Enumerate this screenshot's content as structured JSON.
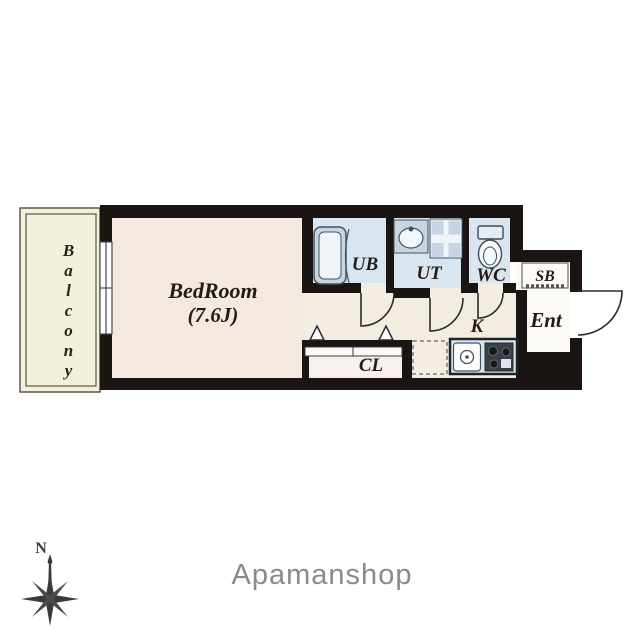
{
  "floorplan": {
    "labels": {
      "balcony": "Balcony",
      "bedroom": "BedRoom",
      "bedroom_size": "(7.6J)",
      "unit_bath": "UB",
      "utility": "UT",
      "toilet": "WC",
      "shoe_box": "SB",
      "entrance": "Ent",
      "kitchen": "K",
      "closet": "CL"
    },
    "colors": {
      "wall": "#1a1512",
      "bedroom": "#f4e9e0",
      "corridor": "#f2ede0",
      "balcony": "#f4f1da",
      "wet_room": "#d9e6f0",
      "fixture": "#c7d5e2",
      "closet": "#f8f0ea",
      "entry": "#fbfaf6",
      "line": "#2b2b2b",
      "label_text": "#241b15"
    }
  },
  "compass": {
    "north_label": "N",
    "color": "#3a3a3a"
  },
  "branding": {
    "logo_text": "Apamanshop",
    "color": "#8a8a8a"
  }
}
